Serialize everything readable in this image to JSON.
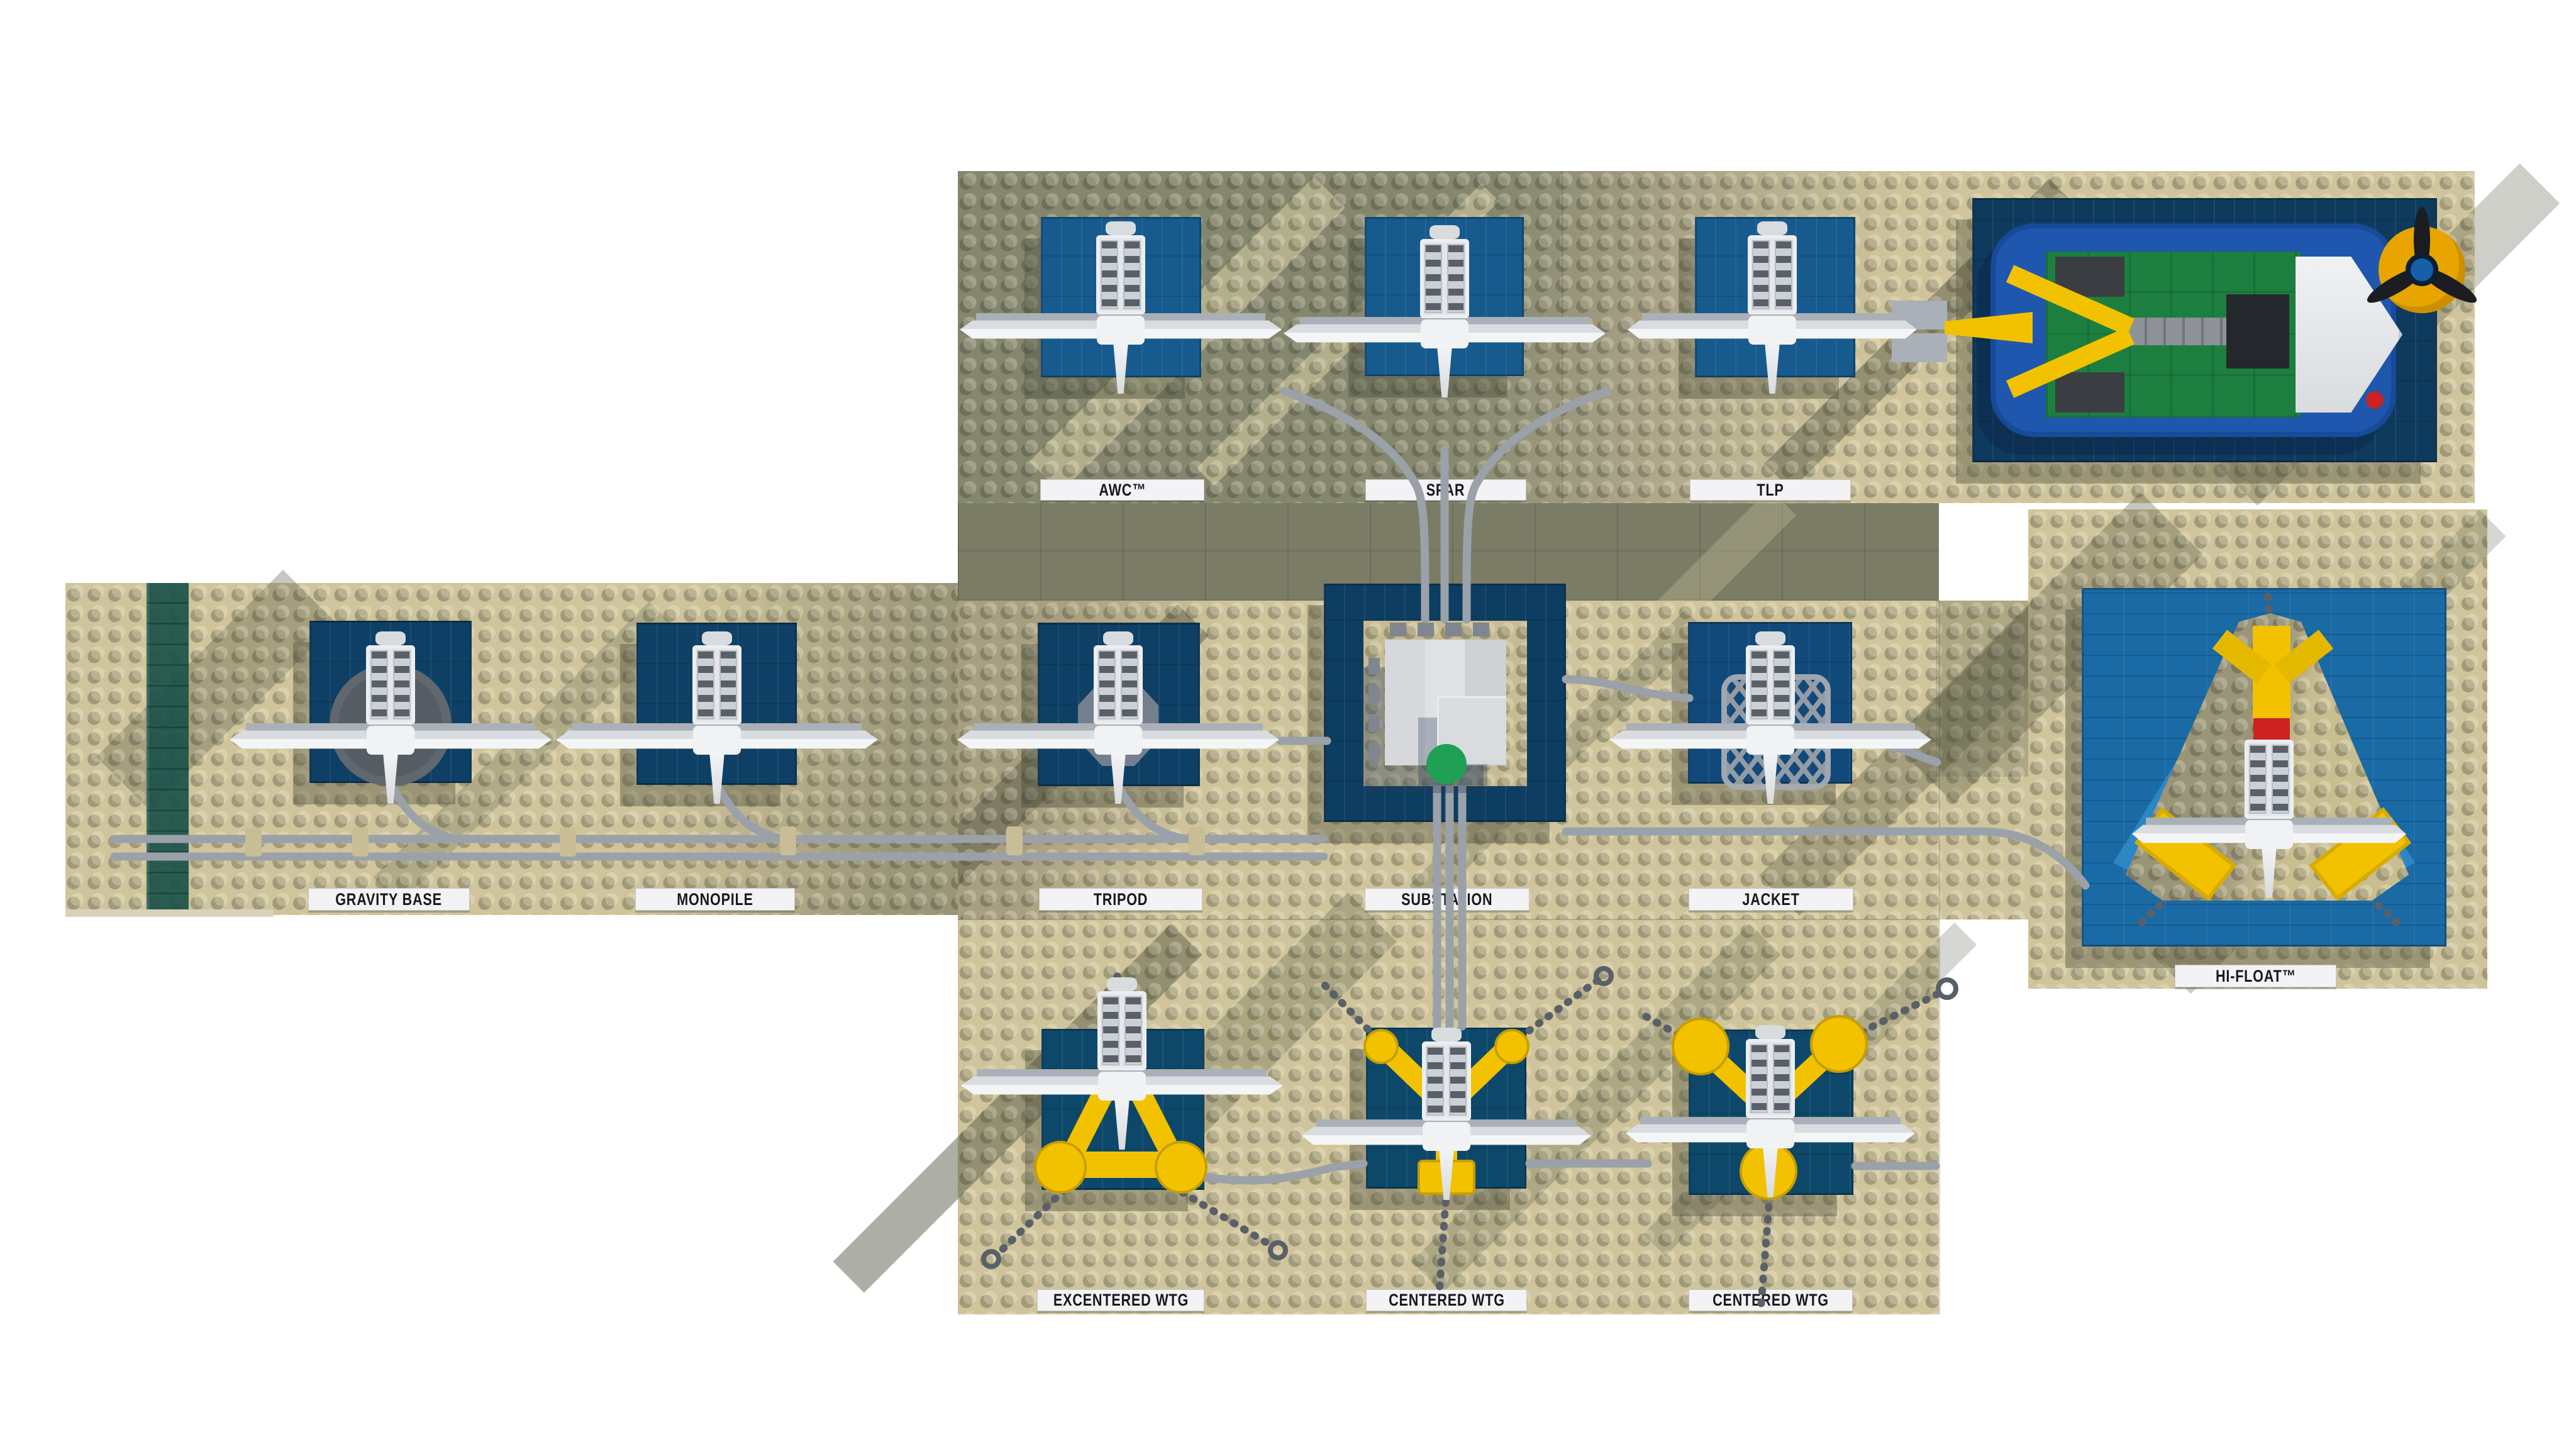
{
  "labels": {
    "awc": "AWC™",
    "spar": "SPAR",
    "tlp": "TLP",
    "gravity_base": "Gravity Base",
    "monopile": "Monopile",
    "tripod": "Tripod",
    "substation": "Substation",
    "jacket": "Jacket",
    "hi_float": "Hi-Float™",
    "excentered_wtg": "Excentered WTG",
    "centered_wtg_1": "Centered WTG",
    "centered_wtg_2": "Centered WTG"
  },
  "stud_embossing": "LEGO",
  "colors": {
    "baseplate_tan": "#cfc49b",
    "baseplate_shadow": "#84866e",
    "flat_tile_band": "#7b7c66",
    "water_navy": "#0e4066",
    "water_navy_lit": "#175a8e",
    "water_teal": "#0d486b",
    "hifloat_blue": "#1a6aa6",
    "cable_gray": "#9ba1a9",
    "chain_gray": "#596068",
    "turbine_white": "#f2f3f5",
    "nacelle_gray": "#cdd1d6",
    "float_yellow": "#f2c200",
    "hull_blue": "#1e57ad",
    "deck_green": "#1d7f3f",
    "helipad_green": "#1fa055",
    "signal_red": "#cc2222",
    "label_bg": "#f3f3f5",
    "label_text": "#17171c",
    "seaweed_teal": "#1d564d"
  }
}
